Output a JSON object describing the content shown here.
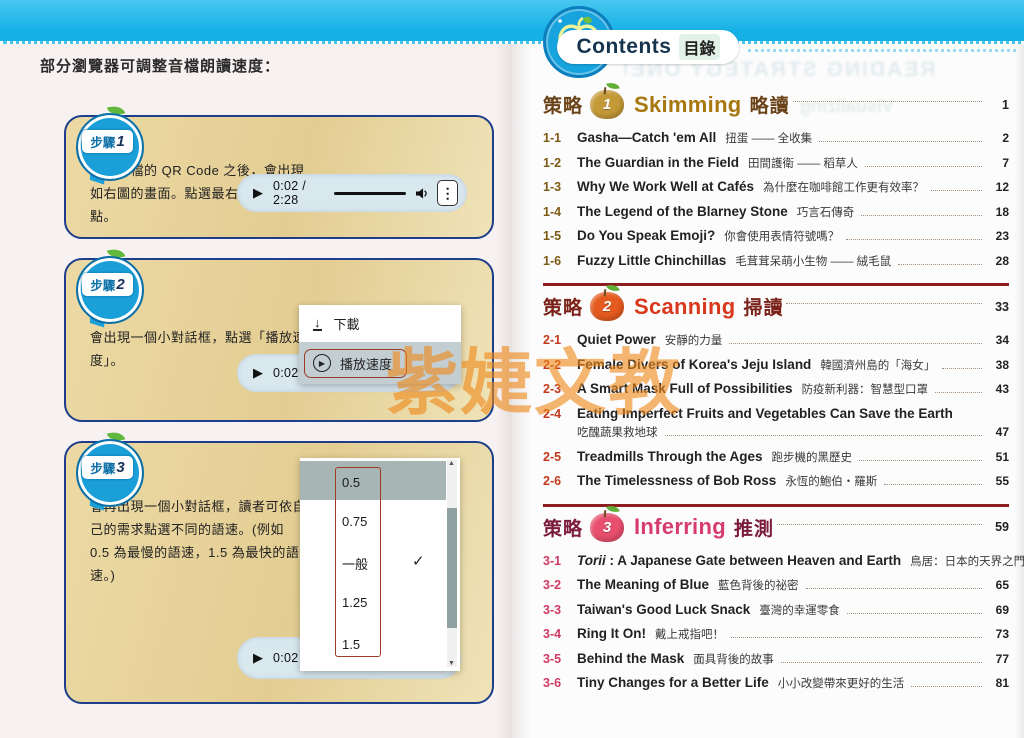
{
  "banner": {
    "title_en": "Contents",
    "title_zh": "目錄"
  },
  "watermark": "紫婕文教",
  "icons": {
    "play": "▶",
    "kebab": "⋮",
    "download_arrow": "↓",
    "circled_play": "▶",
    "check": "✓",
    "scroll_up": "▲",
    "scroll_down": "▼"
  },
  "theme": {
    "banner_cyan": "#14b0e6",
    "panel_bg": "#e7d29a",
    "panel_border": "#1d3e8a",
    "rule_red": "#8b1f1f",
    "section1_accent": "#a8780f",
    "section2_accent": "#d8391c",
    "section3_accent": "#d63d6e",
    "watermark_orange": "#ee8a1a"
  },
  "ghost": {
    "line1": "READING STRATEGY ONE!",
    "line2": "Visualizing"
  },
  "left_page": {
    "intro": "部分瀏覽器可調整音檔朗讀速度：",
    "steps": [
      {
        "badge": "步驟",
        "num": "1",
        "text": "掃描音檔的 QR Code 之後，會出現如右圖的畫面。點選最右邊的三個點。",
        "player_time": "0:02 / 2:28"
      },
      {
        "badge": "步驟",
        "num": "2",
        "text": "會出現一個小對話框，點選「播放速度」。",
        "player_time": "0:02 /",
        "menu": {
          "download": "下載",
          "speed": "播放速度"
        }
      },
      {
        "badge": "步驟",
        "num": "3",
        "text": "會再出現一個小對話框，讀者可依自己的需求點選不同的語速。(例如 0.5 為最慢的語速，1.5 為最快的語速。)",
        "player_time": "0:02 /",
        "options": [
          "0.5",
          "0.75",
          "一般",
          "1.25",
          "1.5"
        ],
        "selected_option": "一般"
      }
    ]
  },
  "right_page": {
    "sections": [
      {
        "label": "策略",
        "num": "1",
        "en": "Skimming",
        "zh": "略讀",
        "page": "1",
        "items": [
          {
            "no": "1-1",
            "en": "Gasha—Catch 'em All",
            "zh": "扭蛋 —— 全收集",
            "page": "2"
          },
          {
            "no": "1-2",
            "en": "The Guardian in the Field",
            "zh": "田間護衛 —— 稻草人",
            "page": "7"
          },
          {
            "no": "1-3",
            "en": "Why We Work Well at Cafés",
            "zh": "為什麼在咖啡館工作更有效率？",
            "page": "12"
          },
          {
            "no": "1-4",
            "en": "The Legend of the Blarney Stone",
            "zh": "巧言石傳奇",
            "page": "18"
          },
          {
            "no": "1-5",
            "en": "Do You Speak Emoji?",
            "zh": "你會使用表情符號嗎？",
            "page": "23"
          },
          {
            "no": "1-6",
            "en": "Fuzzy Little Chinchillas",
            "zh": "毛茸茸呆萌小生物 —— 絨毛鼠",
            "page": "28"
          }
        ]
      },
      {
        "label": "策略",
        "num": "2",
        "en": "Scanning",
        "zh": "掃讀",
        "page": "33",
        "items": [
          {
            "no": "2-1",
            "en": "Quiet Power",
            "zh": "安靜的力量",
            "page": "34"
          },
          {
            "no": "2-2",
            "en": "Female Divers of Korea's Jeju Island",
            "zh": "韓國濟州島的「海女」",
            "page": "38"
          },
          {
            "no": "2-3",
            "en": "A Smart Mask Full of Possibilities",
            "zh": "防疫新利器：智慧型口罩",
            "page": "43"
          },
          {
            "no": "2-4",
            "en": "Eating Imperfect Fruits and Vegetables Can Save the Earth",
            "zh": "吃醜蔬果救地球",
            "page": "47"
          },
          {
            "no": "2-5",
            "en": "Treadmills Through the Ages",
            "zh": "跑步機的黑歷史",
            "page": "51"
          },
          {
            "no": "2-6",
            "en": "The Timelessness of Bob Ross",
            "zh": "永恆的鮑伯・羅斯",
            "page": "55"
          }
        ]
      },
      {
        "label": "策略",
        "num": "3",
        "en": "Inferring",
        "zh": "推測",
        "page": "59",
        "items": [
          {
            "no": "3-1",
            "em": "Torii",
            "en": " : A Japanese Gate between Heaven and Earth",
            "zh": "鳥居：日本的天界之門",
            "page": "60"
          },
          {
            "no": "3-2",
            "en": "The Meaning of Blue",
            "zh": "藍色背後的祕密",
            "page": "65"
          },
          {
            "no": "3-3",
            "en": "Taiwan's Good Luck Snack",
            "zh": "臺灣的幸運零食",
            "page": "69"
          },
          {
            "no": "3-4",
            "en": "Ring It On!",
            "zh": "戴上戒指吧！",
            "page": "73"
          },
          {
            "no": "3-5",
            "en": "Behind the Mask",
            "zh": "面具背後的故事",
            "page": "77"
          },
          {
            "no": "3-6",
            "en": "Tiny Changes for a Better Life",
            "zh": "小小改變帶來更好的生活",
            "page": "81"
          }
        ]
      }
    ]
  }
}
